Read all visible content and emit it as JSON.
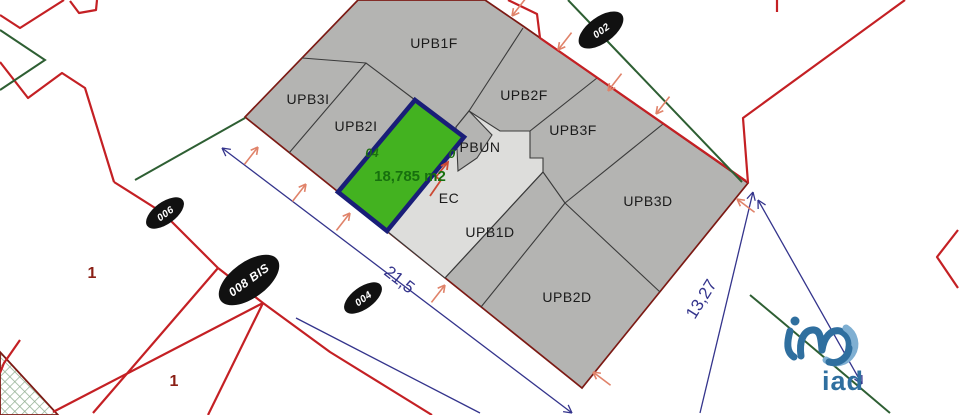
{
  "map": {
    "title": "cadastral parcel plan",
    "parcels": [
      {
        "id": "upb1f",
        "label": "UPB1F"
      },
      {
        "id": "upb2f",
        "label": "UPB2F"
      },
      {
        "id": "upb3f",
        "label": "UPB3F"
      },
      {
        "id": "upb3i",
        "label": "UPB3I"
      },
      {
        "id": "upb2i",
        "label": "UPB2I"
      },
      {
        "id": "pbun",
        "label": "PBUN"
      },
      {
        "id": "upb3d",
        "label": "UPB3D"
      },
      {
        "id": "ec",
        "label": "EC"
      },
      {
        "id": "upb1d",
        "label": "UPB1D"
      },
      {
        "id": "upb2d",
        "label": "UPB2D"
      }
    ],
    "selected_parcel": {
      "area_label": "18,785 m2",
      "left_code": "04",
      "right_code": "0",
      "fill_color": "#43b220",
      "border_color": "#191d78",
      "area_text_color": "#17700e"
    },
    "road_badges": [
      {
        "label": "002"
      },
      {
        "label": "006"
      },
      {
        "label": "008 BIS"
      },
      {
        "label": "004"
      }
    ],
    "dimensions": [
      {
        "label": "21,5"
      },
      {
        "label": "13,27"
      }
    ],
    "zone_markers": [
      {
        "label": "1"
      },
      {
        "label": "1"
      }
    ],
    "colors": {
      "parcel_gray": "#b4b4b2",
      "parcel_light": "#dddddb",
      "road_red": "#c42024",
      "boundary_maroon": "#7c1a14",
      "dimension_navy": "#34348c",
      "limit_green": "#2e5f33",
      "arrow_orange": "#e0836a",
      "badge_black": "#111111"
    },
    "logo": {
      "text": "iad"
    }
  }
}
